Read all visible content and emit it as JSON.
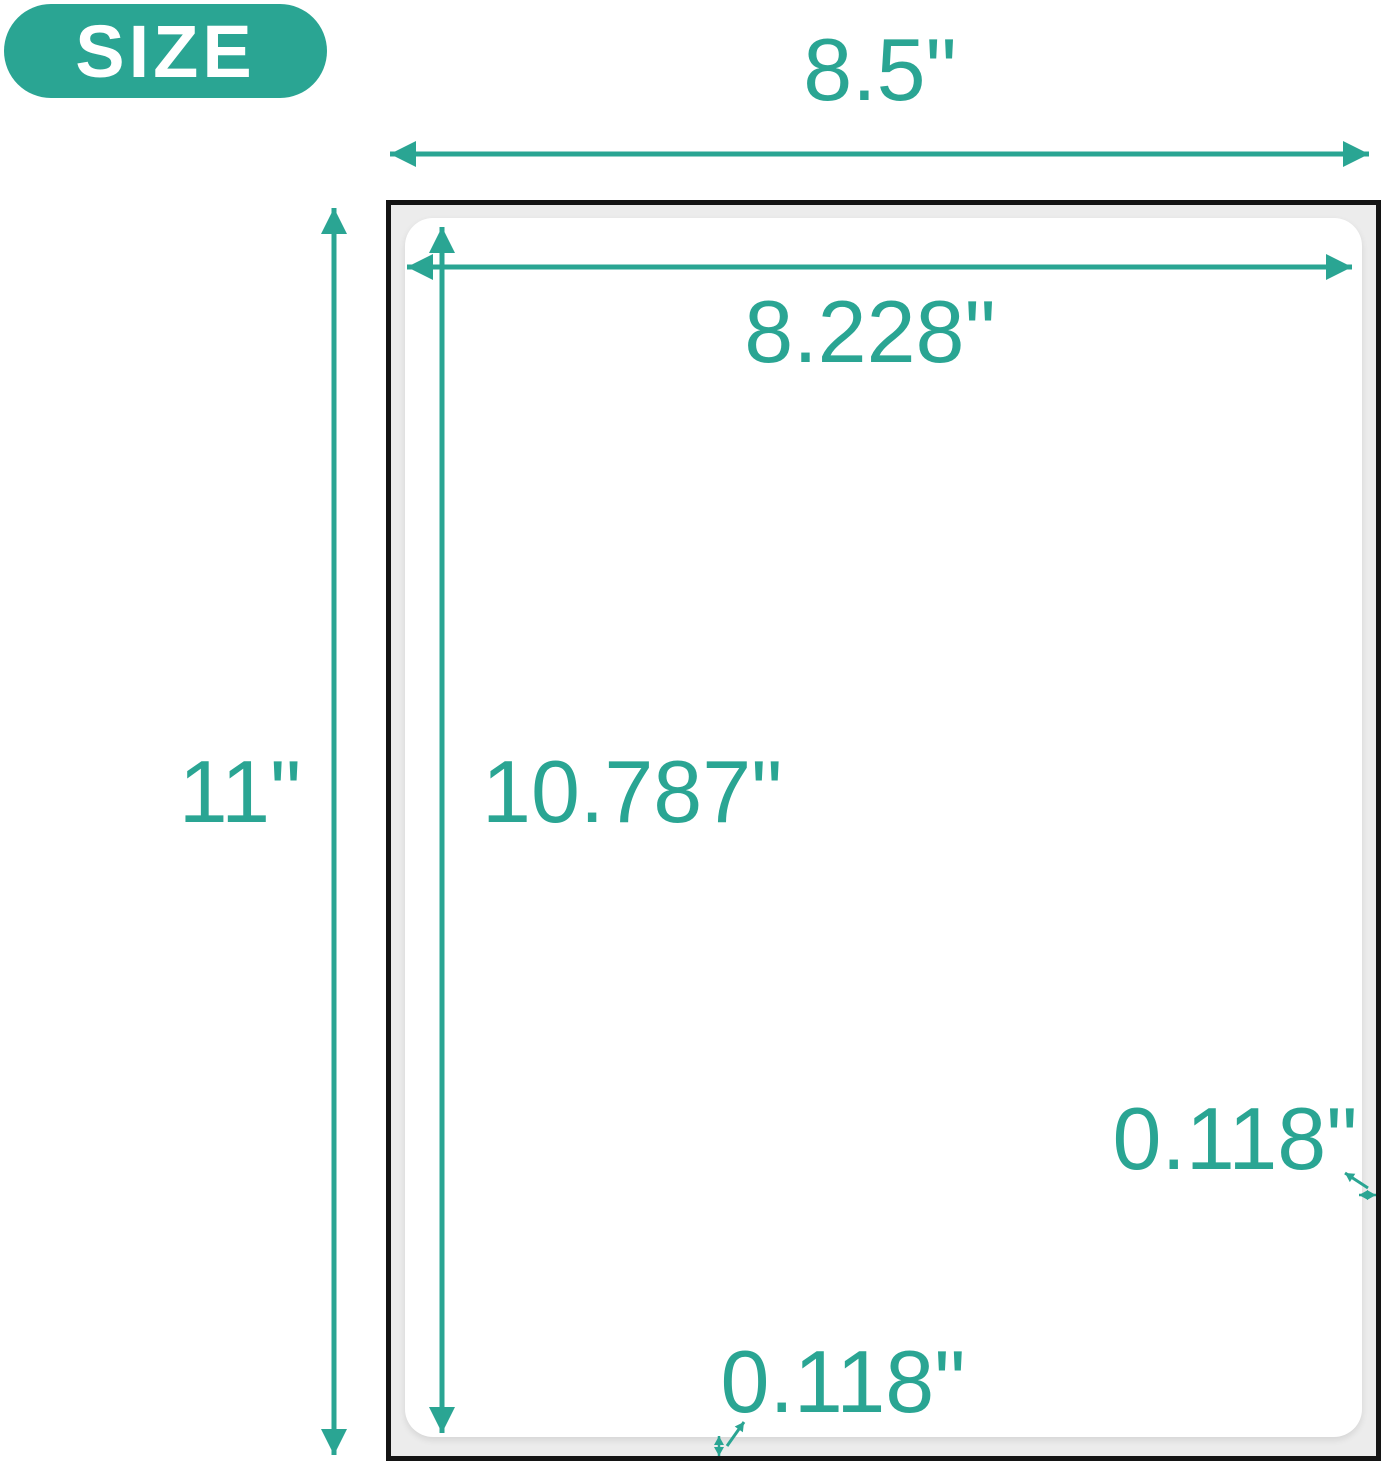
{
  "badge": {
    "label": "SIZE"
  },
  "labels": {
    "sheet_width": "8.5\"",
    "sheet_height": "11\"",
    "label_width": "8.228\"",
    "label_height": "10.787\"",
    "margin_right": "0.118\"",
    "margin_bottom": "0.118\""
  },
  "colors": {
    "accent": "#2AA593",
    "paper_fill": "#ECECEC",
    "paper_border": "#141414",
    "badge_text": "#FFFFFF",
    "page_bg": "#FFFFFF"
  }
}
